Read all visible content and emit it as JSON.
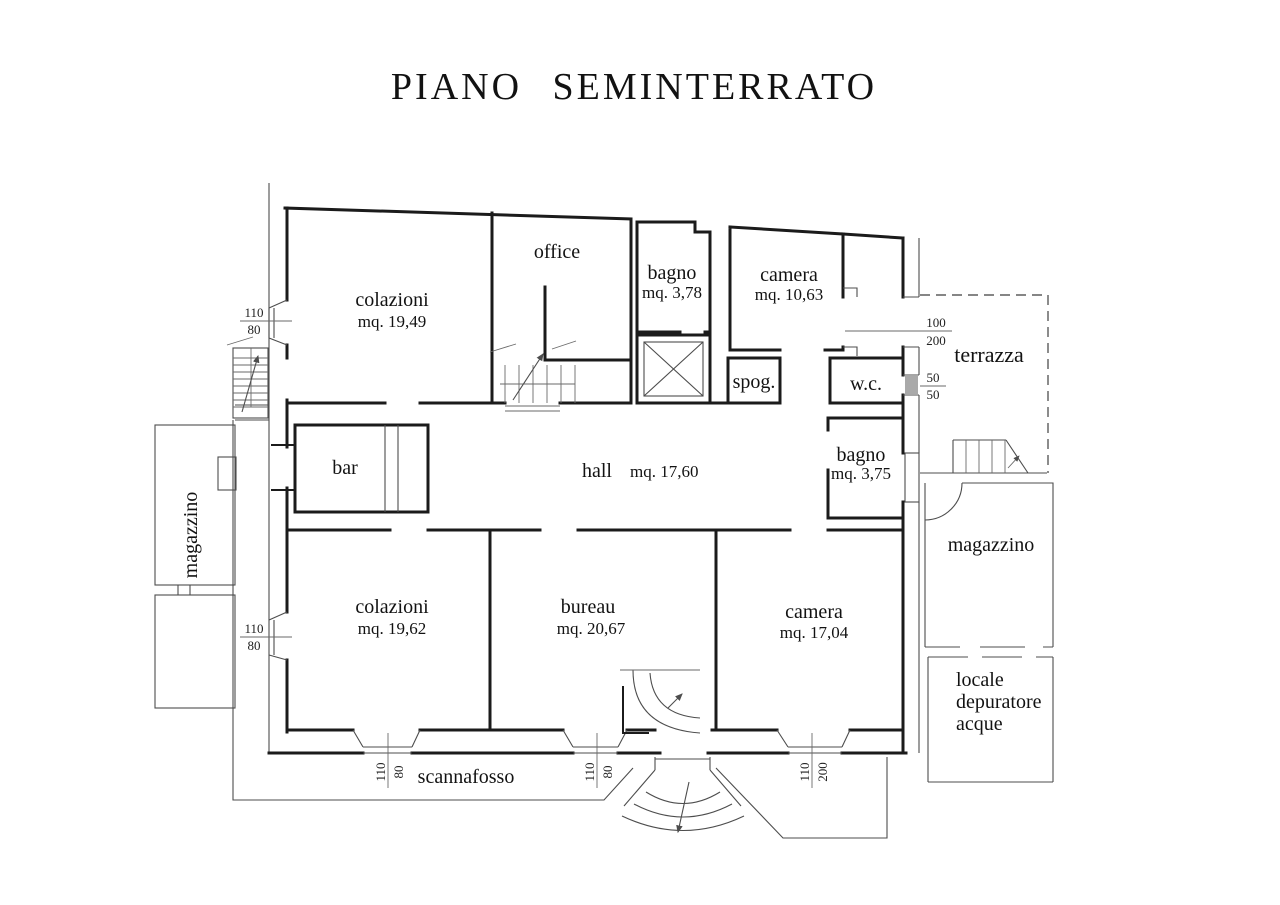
{
  "title": "PIANO  SEMINTERRATO",
  "rooms": {
    "colazioni1": {
      "name": "colazioni",
      "area": "mq. 19,49"
    },
    "office": {
      "name": "office"
    },
    "bagno1": {
      "name": "bagno",
      "area": "mq. 3,78"
    },
    "camera1": {
      "name": "camera",
      "area": "mq. 10,63"
    },
    "spog": {
      "name": "spog."
    },
    "wc": {
      "name": "w.c."
    },
    "bagno2": {
      "name": "bagno",
      "area": "mq. 3,75"
    },
    "hall": {
      "name": "hall",
      "area": "mq. 17,60"
    },
    "bar": {
      "name": "bar"
    },
    "colazioni2": {
      "name": "colazioni",
      "area": "mq. 19,62"
    },
    "bureau": {
      "name": "bureau",
      "area": "mq. 20,67"
    },
    "camera2": {
      "name": "camera",
      "area": "mq. 17,04"
    },
    "terrazza": {
      "name": "terrazza"
    },
    "magazzino_left": {
      "name": "magazzino"
    },
    "magazzino_right": {
      "name": "magazzino"
    },
    "locale": {
      "line1": "locale",
      "line2": "depuratore",
      "line3": "acque"
    },
    "scannafosso": {
      "name": "scannafosso"
    }
  },
  "dims": {
    "west_top": {
      "w": "110",
      "h": "80"
    },
    "west_bottom": {
      "w": "110",
      "h": "80"
    },
    "terrace_door": {
      "w": "100",
      "h": "200"
    },
    "wc_window": {
      "w": "50",
      "h": "50"
    },
    "south_win1": {
      "w": "110",
      "h": "80"
    },
    "south_win2": {
      "w": "110",
      "h": "80"
    },
    "south_win3": {
      "w": "110",
      "h": "200"
    }
  },
  "colors": {
    "wall": "#1b1b1b",
    "thin": "#4d4d4d",
    "paper": "#ffffff"
  }
}
